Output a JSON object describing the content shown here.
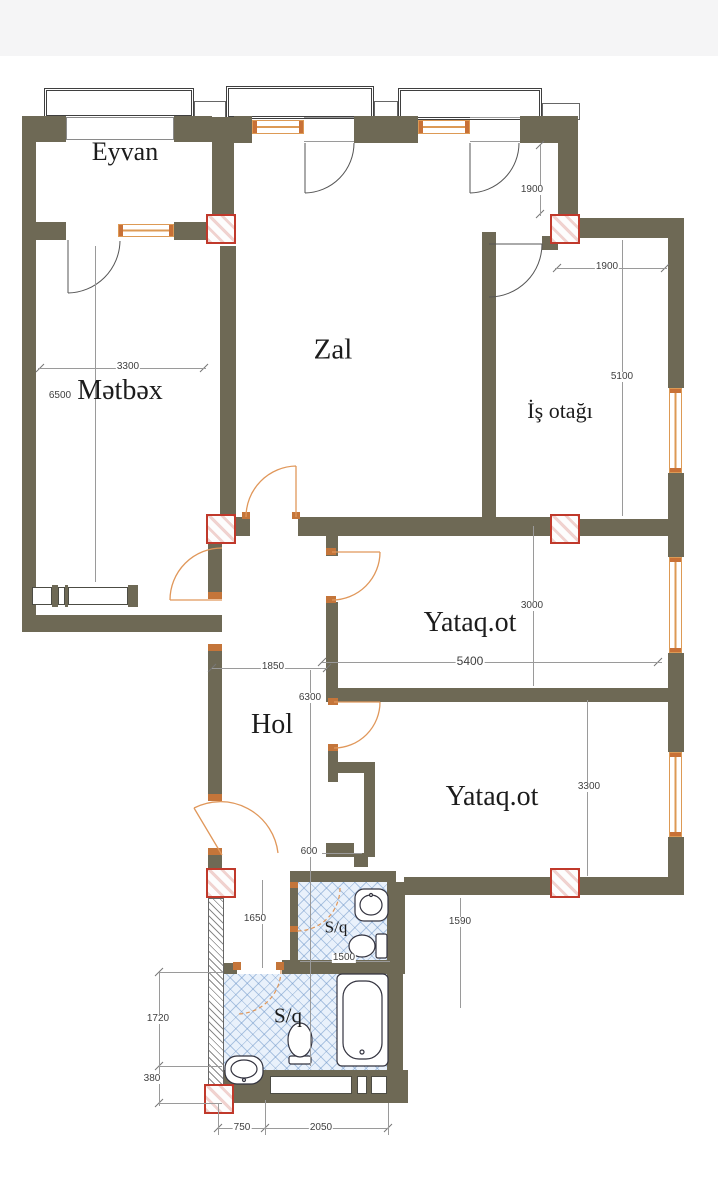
{
  "colors": {
    "wall": "#6e6955",
    "window": "#dd9a55",
    "door": "#e0975a",
    "marker": "#c0392b",
    "tile": "#e9f1fb",
    "dim": "#3f3f3f",
    "label": "#1c1c1c"
  },
  "rooms": {
    "eyvan": {
      "label": "Eyvan"
    },
    "zal": {
      "label": "Zal"
    },
    "metbex": {
      "label": "Mətbəx"
    },
    "is_otagi": {
      "label": "İş otağı"
    },
    "yataq1": {
      "label": "Yataq.ot"
    },
    "hol": {
      "label": "Hol"
    },
    "yataq2": {
      "label": "Yataq.ot"
    },
    "sq1": {
      "label": "S/q"
    },
    "sq2": {
      "label": "S/q"
    }
  },
  "dims": {
    "zal_height": "1900",
    "is_width": "1900",
    "is_height": "5100",
    "metbex_width": "3300",
    "metbex_height": "6500",
    "yataq1_height": "3000",
    "yataq1_width": "5400",
    "hol_width": "1850",
    "hol_height": "6300",
    "niche": "600",
    "sq1_height": "1650",
    "yataq2_offset": "1590",
    "sq1_width": "1500",
    "yataq2_height": "3300",
    "sq2_height": "1720",
    "sq2_offset": "380",
    "bottom_left": "750",
    "bottom_right": "2050"
  },
  "icons": {
    "fixtures": [
      "sink-icon",
      "toilet-icon",
      "bathtub-icon"
    ],
    "structure": [
      "column-marker",
      "door-arc",
      "window",
      "balcony-rail"
    ]
  }
}
